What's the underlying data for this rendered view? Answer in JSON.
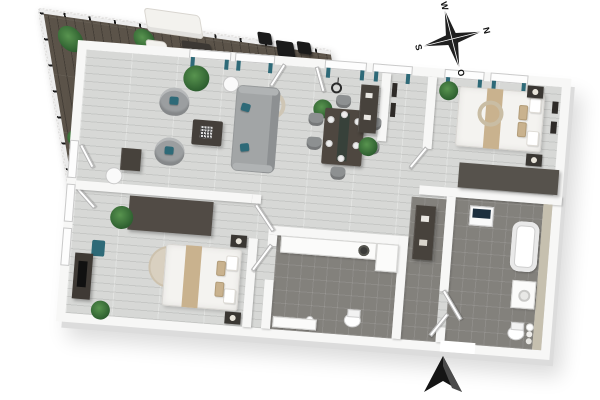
{
  "scene": {
    "kind": "3d-floor-plan",
    "view": "top-down isometric render of a two-bedroom apartment with a large wood-deck balcony",
    "visible_text": "compass letters only"
  },
  "compass": {
    "top": "W",
    "right": "N",
    "bottom": "O",
    "left": "S"
  },
  "entrance": {
    "marker": "black up-pointing arrow at front door opening in bottom wall"
  },
  "palette": {
    "background": "#ffffff",
    "wall": "#f7f7f6",
    "floor": "#d7d8d6",
    "tile": "#83817c",
    "deck": "#5b5349",
    "beige_wall": "#c6c0af",
    "accent_teal": "#2e6a78",
    "accent_tan": "#c9b28e",
    "navy": "#1d2f3e",
    "dark_furniture": "#47423c",
    "sofa_gray": "#a2a5a6",
    "plant_green": "#3a7a3c",
    "arrow_black": "#141414"
  },
  "rooms": [
    {
      "id": "balcony-terrace",
      "floor": "dark-wood-deck",
      "items": [
        {
          "name": "glass-railing",
          "count": 1
        },
        {
          "name": "potted-plant",
          "count": 4
        },
        {
          "name": "sun-lounger",
          "count": 2
        },
        {
          "name": "outdoor-sofa",
          "count": 1
        },
        {
          "name": "outdoor-armchair",
          "count": 2
        },
        {
          "name": "outdoor-coffee-table",
          "count": 1
        },
        {
          "name": "bistro-table-black",
          "count": 1
        },
        {
          "name": "bistro-chair-black",
          "count": 3
        }
      ]
    },
    {
      "id": "living-room",
      "floor": "light-wood",
      "items": [
        {
          "name": "sofa-gray",
          "count": 1
        },
        {
          "name": "swivel-armchair",
          "count": 2
        },
        {
          "name": "coffee-table-dark",
          "count": 1
        },
        {
          "name": "hanging-egg-chair",
          "count": 1
        },
        {
          "name": "side-table",
          "count": 1
        },
        {
          "name": "tv-shelf",
          "count": 1
        },
        {
          "name": "round-table",
          "count": 1
        },
        {
          "name": "potted-plant",
          "count": 2
        },
        {
          "name": "window-with-teal-curtains",
          "count": 4
        },
        {
          "name": "open-glass-door",
          "count": 4
        }
      ]
    },
    {
      "id": "dining-area",
      "floor": "light-wood",
      "items": [
        {
          "name": "dining-table-dark",
          "count": 1
        },
        {
          "name": "dining-chair",
          "count": 6
        },
        {
          "name": "dinner-plate",
          "count": 6
        },
        {
          "name": "pendant-lamp",
          "count": 1
        },
        {
          "name": "console-table",
          "count": 1
        },
        {
          "name": "wall-art-frame",
          "count": 2
        },
        {
          "name": "potted-plant",
          "count": 1
        }
      ]
    },
    {
      "id": "bedroom-1",
      "floor": "light-wood",
      "items": [
        {
          "name": "double-bed-tan-runner",
          "count": 1
        },
        {
          "name": "nightstand-with-lamp",
          "count": 2
        },
        {
          "name": "wide-dresser",
          "count": 1
        },
        {
          "name": "ceiling-ring-light",
          "count": 1
        },
        {
          "name": "wall-art-frame",
          "count": 2
        },
        {
          "name": "potted-plant",
          "count": 1
        },
        {
          "name": "window-with-teal-curtains",
          "count": 2
        }
      ]
    },
    {
      "id": "bedroom-2",
      "floor": "light-wood",
      "items": [
        {
          "name": "double-bed-tan-runner",
          "count": 1
        },
        {
          "name": "wardrobe",
          "count": 1
        },
        {
          "name": "round-rug",
          "count": 1
        },
        {
          "name": "nightstand-with-lamp",
          "count": 2
        },
        {
          "name": "media-console-with-tv",
          "count": 1
        },
        {
          "name": "accent-chair-teal",
          "count": 1
        },
        {
          "name": "potted-plant",
          "count": 2
        }
      ]
    },
    {
      "id": "bathroom-main",
      "floor": "dark-tile",
      "items": [
        {
          "name": "vanity-counter",
          "count": 1
        },
        {
          "name": "vessel-sink-dark",
          "count": 1
        },
        {
          "name": "tall-cabinet",
          "count": 1
        },
        {
          "name": "toilet",
          "count": 1
        },
        {
          "name": "shower-fixture",
          "count": 1
        },
        {
          "name": "bath-ledge",
          "count": 1
        }
      ]
    },
    {
      "id": "bathroom-ensuite",
      "floor": "dark-tile",
      "items": [
        {
          "name": "bathtub",
          "count": 1
        },
        {
          "name": "vanity-with-sink",
          "count": 1
        },
        {
          "name": "toilet",
          "count": 1
        },
        {
          "name": "washer-navy-top",
          "count": 1
        },
        {
          "name": "towel-rolls",
          "count": 1
        },
        {
          "name": "beige-accent-wall",
          "count": 1
        }
      ]
    },
    {
      "id": "hallway",
      "floor": "dark-tile",
      "items": [
        {
          "name": "sideboard-dark",
          "count": 1
        },
        {
          "name": "entrance-door-open",
          "count": 1
        }
      ]
    }
  ]
}
